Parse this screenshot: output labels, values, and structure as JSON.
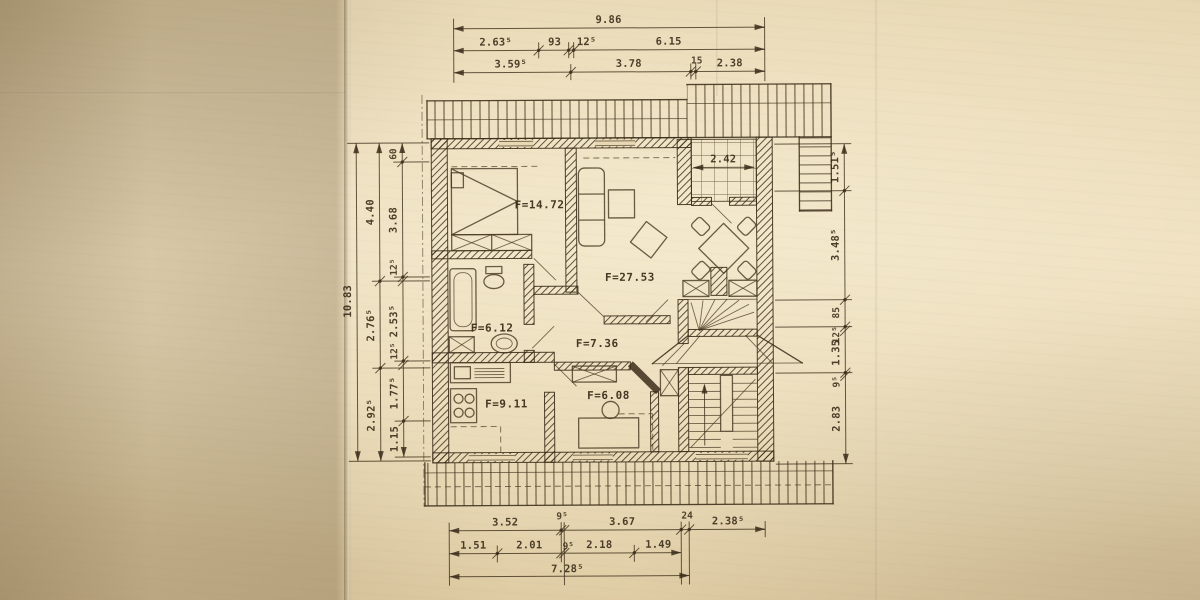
{
  "rooms": {
    "bedroom": {
      "label": "F=14.72"
    },
    "living": {
      "label": "F=27.53"
    },
    "bath": {
      "label": "F=6.12"
    },
    "hall": {
      "label": "F=7.36"
    },
    "kitchen": {
      "label": "F=9.11"
    },
    "child": {
      "label": "F=6.08"
    },
    "balcony": {
      "width": "2.42"
    }
  },
  "dims": {
    "top": {
      "total": "9.86",
      "row2": [
        "2.63⁵",
        "93",
        "12⁵",
        "6.15"
      ],
      "row3": [
        "3.59⁵",
        "3.78",
        "15",
        "2.38"
      ]
    },
    "left": {
      "total": "10.83",
      "mid": [
        "4.40",
        "2.76⁵",
        "2.92⁵"
      ],
      "inner": [
        "60",
        "3.68",
        "12⁵",
        "2.53⁵",
        "12⁵",
        "1.77⁵",
        "1.15"
      ]
    },
    "right": {
      "chain": [
        "1.51⁵",
        "3.48⁵",
        "85",
        "12⁵",
        "1.35",
        "9⁵",
        "2.83"
      ]
    },
    "bottom": {
      "row1": [
        "3.52",
        "9⁵",
        "3.67",
        "24",
        "2.38⁵"
      ],
      "row2": [
        "1.51",
        "2.01",
        "9⁵",
        "2.18",
        "1.49"
      ],
      "total": "7.28⁵"
    }
  },
  "colors": {
    "paper": "#e8d8b4",
    "ink": "#3b2d1a"
  }
}
